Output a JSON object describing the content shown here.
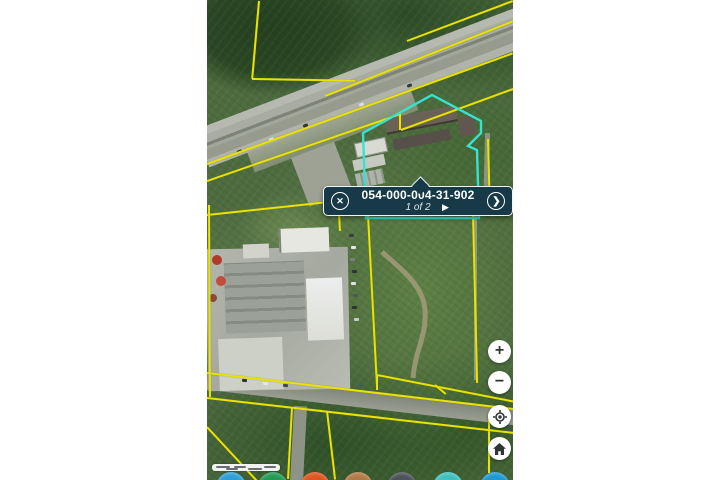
{
  "popup": {
    "parcel_id": "054-000-004-31-902",
    "pagination": "1 of 2"
  },
  "icons": {
    "close": "✕",
    "chevron_right": "❯",
    "play": "▶",
    "zoom_in": "+",
    "zoom_out": "−",
    "locate": "locate-crosshair",
    "home": "home-house"
  },
  "colors": {
    "parcel-line": "#e8e300",
    "selected-parcel": "#35e3d1",
    "popup-bg": "#183a48",
    "popup-border": "#f2f5f6",
    "control-icon": "#2f3437"
  },
  "toolbar_dots": [
    {
      "color": "#2e9fd4"
    },
    {
      "color": "#259a55"
    },
    {
      "color": "#df5420"
    },
    {
      "color": "#b07a45"
    },
    {
      "color": "#4b5258"
    },
    {
      "color": "#3fc0bd"
    },
    {
      "color": "#1f97d0"
    }
  ]
}
